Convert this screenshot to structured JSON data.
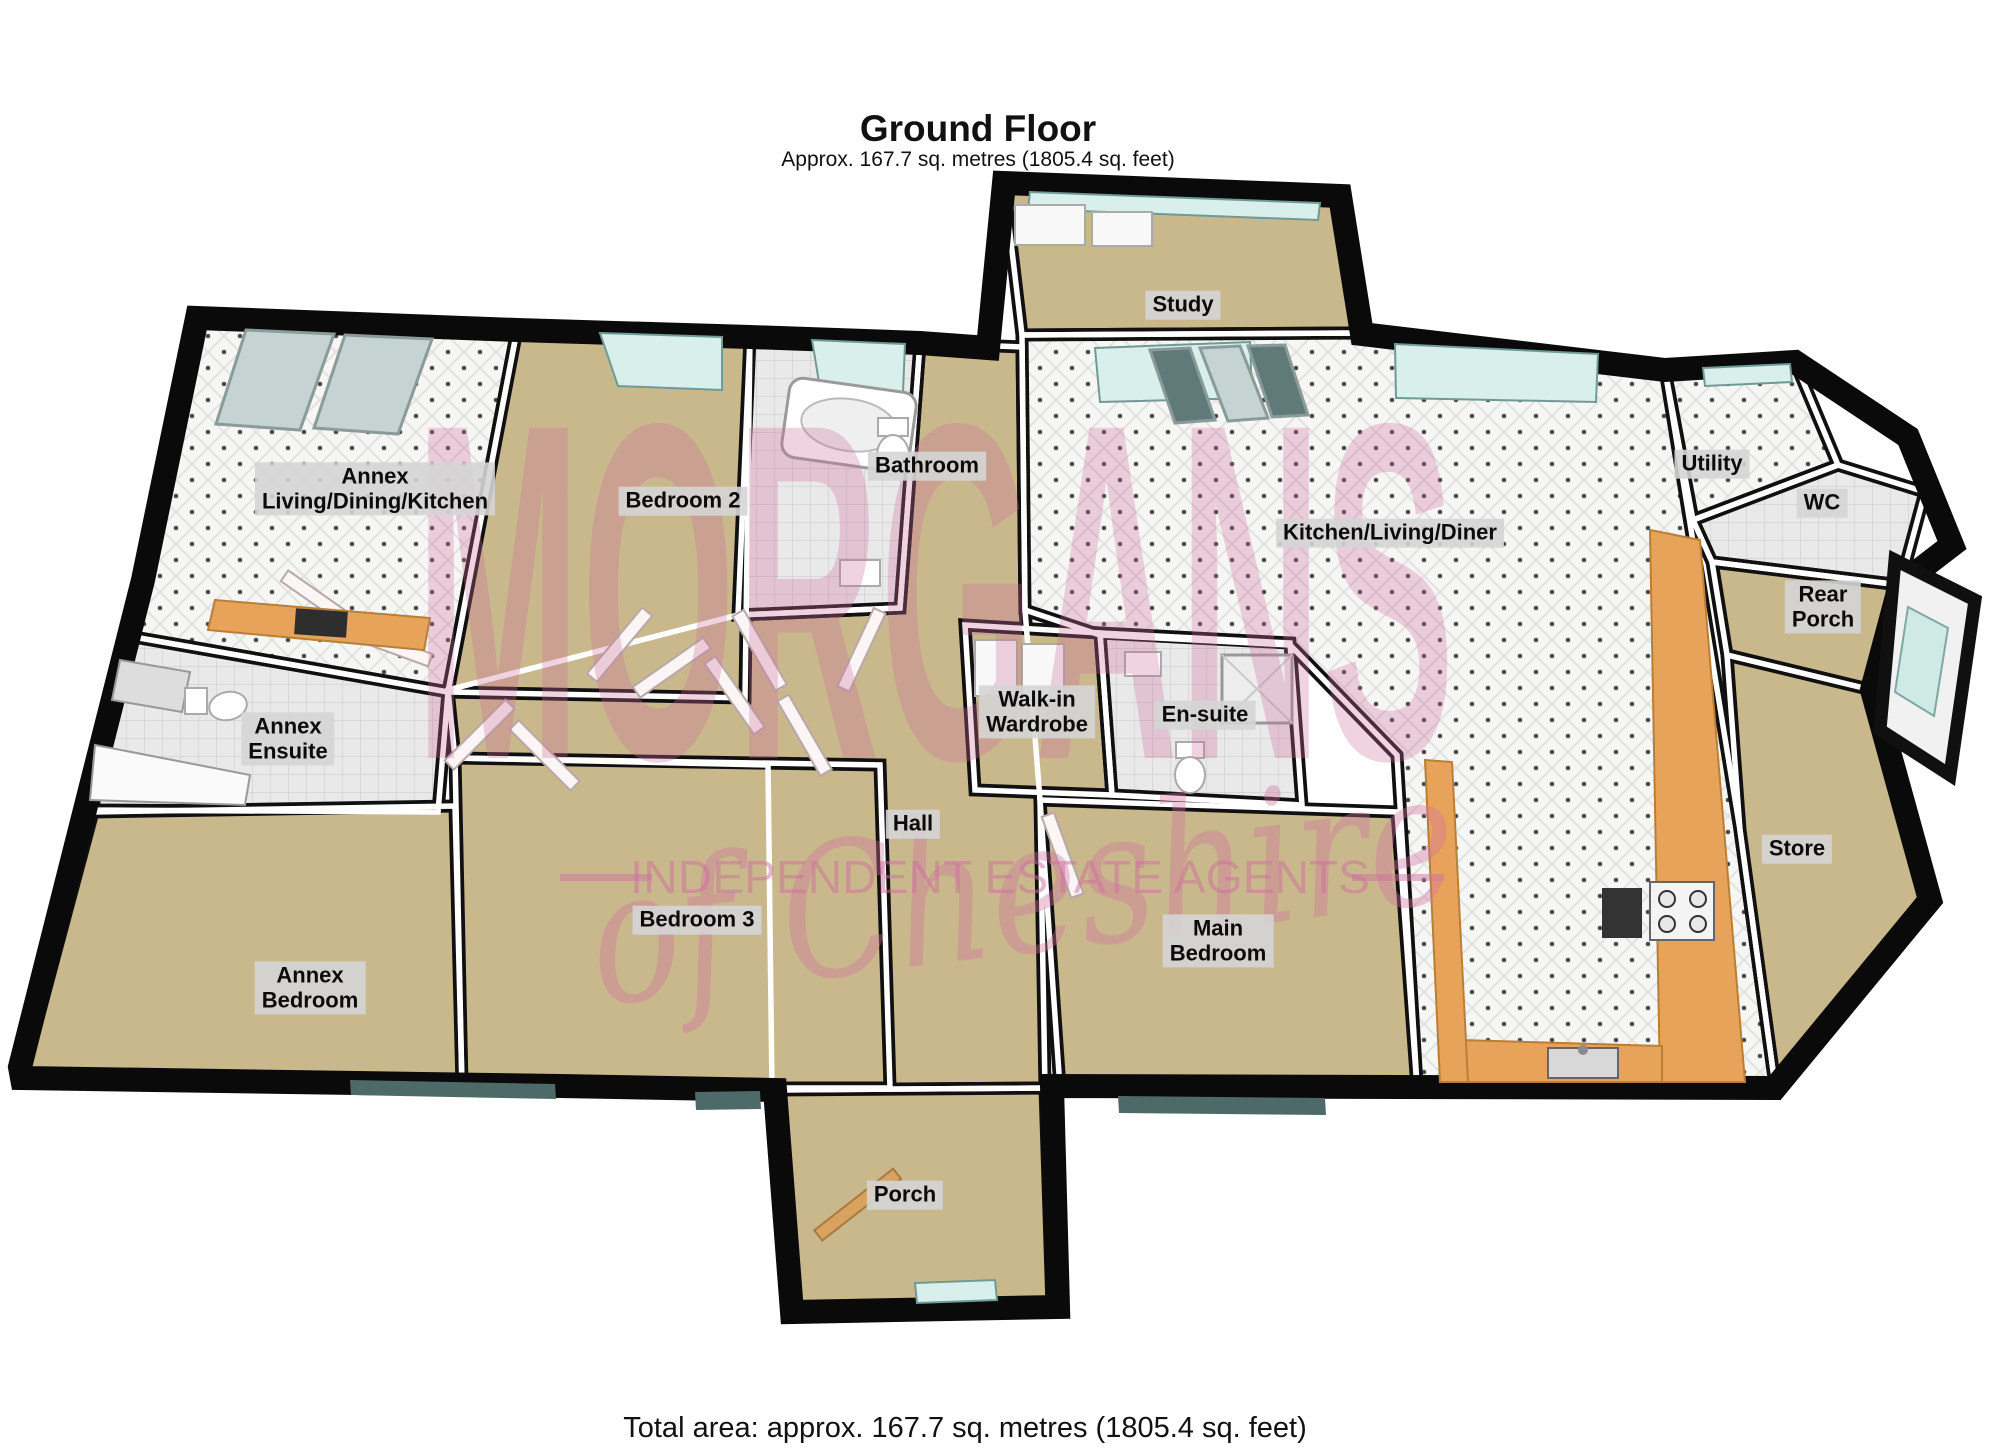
{
  "page": {
    "title": "Ground Floor",
    "subtitle": "Approx. 167.7 sq. metres (1805.4 sq. feet)",
    "footer": "Total area: approx. 167.7 sq. metres (1805.4 sq. feet)"
  },
  "watermark": {
    "brand": "MORGANS",
    "script": "of Cheshire",
    "tagline": "INDEPENDENT ESTATE AGENTS",
    "color": "#cf6f9f"
  },
  "rooms": [
    {
      "id": "study",
      "label": "Study",
      "x": 1183,
      "y": 305
    },
    {
      "id": "annex-living-dining-kitchen",
      "label": "Annex\nLiving/Dining/Kitchen",
      "x": 375,
      "y": 489
    },
    {
      "id": "bedroom-2",
      "label": "Bedroom 2",
      "x": 683,
      "y": 501
    },
    {
      "id": "bathroom",
      "label": "Bathroom",
      "x": 927,
      "y": 466
    },
    {
      "id": "kitchen-living-diner",
      "label": "Kitchen/Living/Diner",
      "x": 1390,
      "y": 533
    },
    {
      "id": "utility",
      "label": "Utility",
      "x": 1712,
      "y": 464
    },
    {
      "id": "wc",
      "label": "WC",
      "x": 1822,
      "y": 503
    },
    {
      "id": "rear-porch",
      "label": "Rear\nPorch",
      "x": 1823,
      "y": 607
    },
    {
      "id": "annex-ensuite",
      "label": "Annex\nEnsuite",
      "x": 288,
      "y": 739
    },
    {
      "id": "walk-in-wardrobe",
      "label": "Walk-in\nWardrobe",
      "x": 1037,
      "y": 712
    },
    {
      "id": "en-suite",
      "label": "En-suite",
      "x": 1205,
      "y": 715
    },
    {
      "id": "hall",
      "label": "Hall",
      "x": 913,
      "y": 824
    },
    {
      "id": "store",
      "label": "Store",
      "x": 1797,
      "y": 849
    },
    {
      "id": "bedroom-3",
      "label": "Bedroom 3",
      "x": 697,
      "y": 920
    },
    {
      "id": "main-bedroom",
      "label": "Main\nBedroom",
      "x": 1218,
      "y": 941
    },
    {
      "id": "annex-bedroom",
      "label": "Annex\nBedroom",
      "x": 310,
      "y": 988
    },
    {
      "id": "porch",
      "label": "Porch",
      "x": 905,
      "y": 1195
    }
  ],
  "colors": {
    "carpet": "#c9b88c",
    "tile_white": "#f6f6f4",
    "tile_grey": "#e9e9e9",
    "counter_orange": "#e8a35b",
    "window_glass": "#d9efec",
    "window_dark": "#4e6a68",
    "wall_black": "#101010",
    "watermark_pink": "#cf6f9f",
    "label_background": "#d5d5d5"
  }
}
